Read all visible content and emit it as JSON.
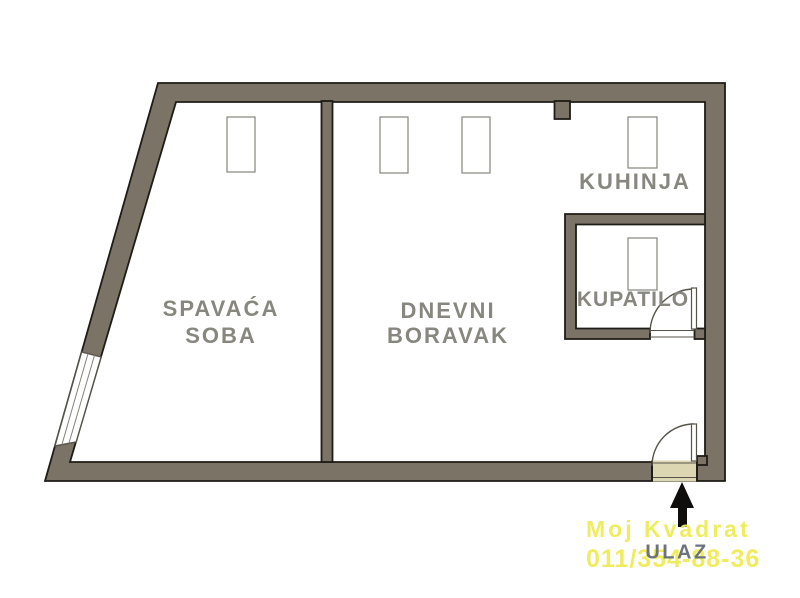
{
  "colors": {
    "background": "#ffffff",
    "wall": "#7b7366",
    "wall_outline": "#1e1c16",
    "floor": "#dcd7b2",
    "room_label": "#87877f",
    "entrance_label": "#6d737c",
    "watermark": "#efec58",
    "fixture": "#ffffff",
    "fixture_border": "#85857c",
    "door": "#56534a",
    "arrow": "#0f0e0c"
  },
  "rooms": {
    "bedroom": {
      "line1": "SPAVAĆA",
      "line2": "SOBA"
    },
    "living": {
      "line1": "DNEVNI",
      "line2": "BORAVAK"
    },
    "kitchen": {
      "label": "KUHINJA"
    },
    "bathroom": {
      "label": "KUPATILO"
    }
  },
  "entrance": {
    "label": "ULAZ",
    "arrow": "up-arrow"
  },
  "watermark": {
    "line1": "Moj Kvadrat",
    "line2": "011/354-88-36"
  }
}
